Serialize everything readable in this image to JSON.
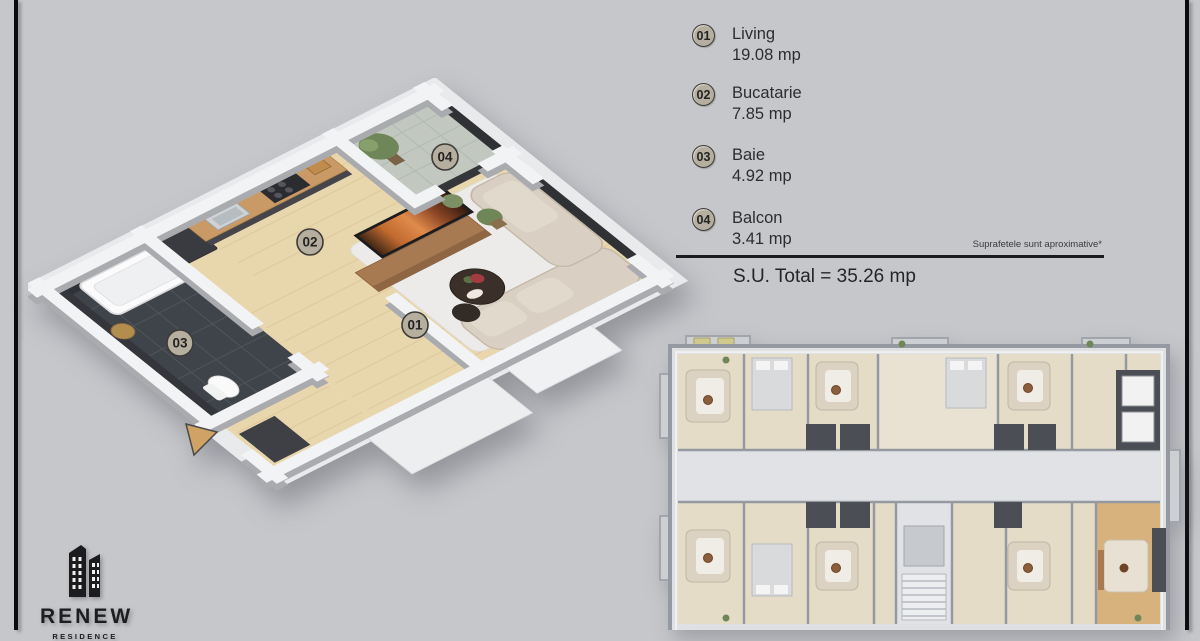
{
  "brand": {
    "name": "RENEW",
    "subtitle": "RESIDENCE",
    "logo_icon": "buildings-icon"
  },
  "legend": {
    "items": [
      {
        "number": "01",
        "name": "Living",
        "area": "19.08 mp"
      },
      {
        "number": "02",
        "name": "Bucatarie",
        "area": "7.85 mp"
      },
      {
        "number": "03",
        "name": "Baie",
        "area": "4.92 mp"
      },
      {
        "number": "04",
        "name": "Balcon",
        "area": "3.41 mp"
      }
    ],
    "note": "Suprafetele sunt aproximative*",
    "total": "S.U. Total = 35.26 mp"
  },
  "colors": {
    "background": "#c6c7cb",
    "frame_line": "#0b0b0d",
    "badge_fill": "#b6ae9f",
    "badge_border": "#3c3b37",
    "accent_arrow": "#d0a264",
    "highlight_unit": "#d7b27c",
    "wood_floor": "#e8d6ac",
    "dark_tile": "#3f434a",
    "wall_white": "#f2f3f4",
    "tv_wood": "#a87a52"
  }
}
